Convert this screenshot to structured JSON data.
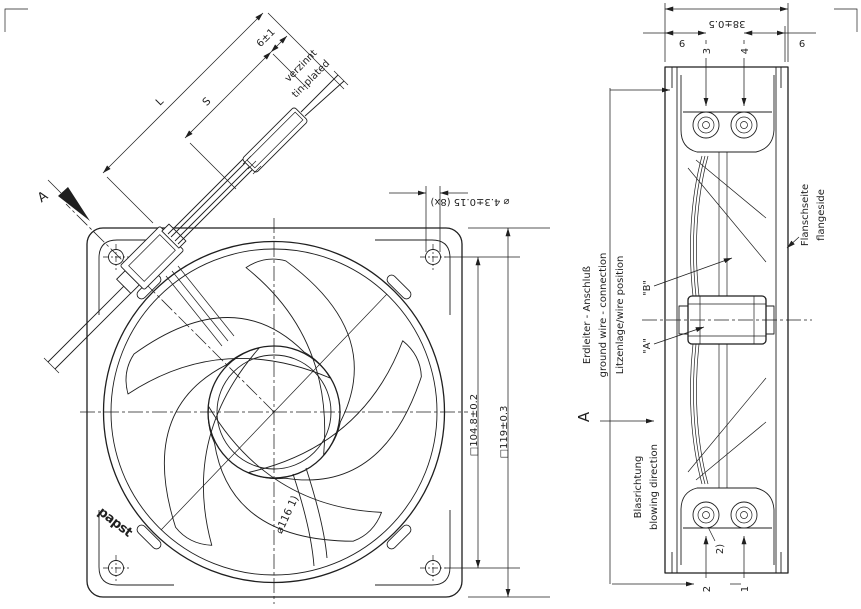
{
  "drawing": {
    "colors": {
      "line": "#1f1f1f",
      "background": "#ffffff"
    },
    "front_view": {
      "view_label": "A",
      "logo": "papst",
      "cable": {
        "length_label": "L",
        "strip_label": "S",
        "tip_dim": "6±1",
        "finish_de": "verzinnt",
        "finish_en": "tin-plated"
      },
      "dims": {
        "mounting_holes": "⌀ 4.3±0.15 (8x)",
        "hole_spacing": "□104.8±0.2",
        "frame_size": "□119±0.3",
        "impeller_diameter": "⌀116 1)"
      }
    },
    "side_view": {
      "dims": {
        "depth": "38±0.5",
        "left_offset": "9",
        "right_offset": "9"
      },
      "terminals": {
        "t3": "3",
        "t4": "4",
        "t2": "2",
        "t1": "1",
        "footnote": "2)"
      },
      "labels": {
        "flange_de": "Flanschseite",
        "flange_en": "flangeside",
        "ground_de": "Erdleiter - Anschluß",
        "ground_en": "ground wire - connection",
        "wire_position": "Litzenlage/wire position",
        "pos_a": "\"A\"",
        "pos_b": "\"B\"",
        "view_label": "A",
        "airflow_de": "Blasrichtung",
        "airflow_en": "blowing direction"
      }
    }
  }
}
